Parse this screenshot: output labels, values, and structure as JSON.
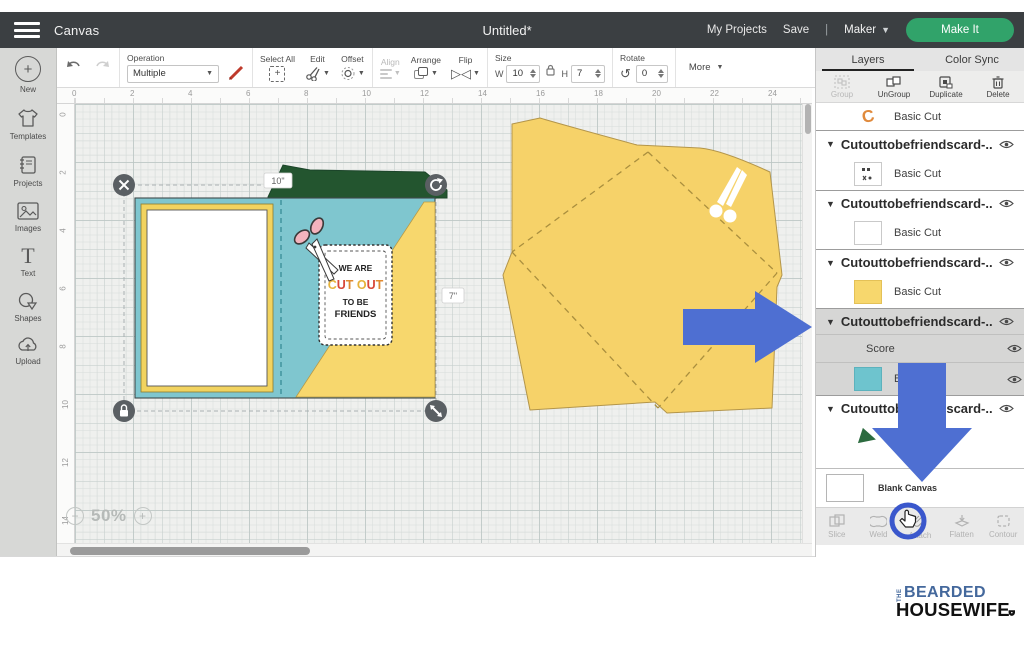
{
  "topbar": {
    "canvas_label": "Canvas",
    "title": "Untitled*",
    "my_projects": "My Projects",
    "save": "Save",
    "divider": "|",
    "machine": "Maker",
    "make_it": "Make It"
  },
  "toolbar": {
    "operation_label": "Operation",
    "operation_value": "Multiple",
    "select_all": "Select All",
    "edit": "Edit",
    "offset": "Offset",
    "align": "Align",
    "arrange": "Arrange",
    "flip": "Flip",
    "size_label": "Size",
    "width_label": "W",
    "width_value": "10",
    "height_label": "H",
    "height_value": "7",
    "rotate_label": "Rotate",
    "rotate_value": "0",
    "more_label": "More"
  },
  "sidebar": {
    "items": [
      {
        "label": "New",
        "icon": "plus-circle-icon"
      },
      {
        "label": "Templates",
        "icon": "tshirt-icon"
      },
      {
        "label": "Projects",
        "icon": "notebook-icon"
      },
      {
        "label": "Images",
        "icon": "image-icon"
      },
      {
        "label": "Text",
        "icon": "text-icon"
      },
      {
        "label": "Shapes",
        "icon": "shapes-icon"
      },
      {
        "label": "Upload",
        "icon": "upload-cloud-icon"
      }
    ]
  },
  "ruler": {
    "horizontal": [
      "0",
      "2",
      "4",
      "6",
      "8",
      "10",
      "12",
      "14",
      "16",
      "18",
      "20",
      "22",
      "24"
    ],
    "vertical": [
      "0",
      "2",
      "4",
      "6",
      "8",
      "10",
      "12",
      "14"
    ]
  },
  "canvas": {
    "zoom_minus": "−",
    "zoom_level": "50%",
    "zoom_plus": "+",
    "selection_width": "10\"",
    "selection_height": "7\"",
    "tag": {
      "line1": "WE ARE",
      "line2": "CUT OUT",
      "line3": "TO BE",
      "line4": "FRIENDS",
      "letter_colors": [
        "#e6b33b",
        "#d8483a",
        "#e08a30"
      ]
    }
  },
  "layers_panel": {
    "tabs": [
      {
        "label": "Layers"
      },
      {
        "label": "Color Sync"
      }
    ],
    "actions": [
      {
        "label": "Group",
        "disabled": true
      },
      {
        "label": "UnGroup"
      },
      {
        "label": "Duplicate"
      },
      {
        "label": "Delete"
      }
    ],
    "rows": [
      {
        "label": "Basic Cut",
        "thumb": "orange-shape"
      },
      {
        "label": "Cutouttobefriendscard-...",
        "type": "group"
      },
      {
        "label": "Basic Cut",
        "thumb": "scissors-glyph"
      },
      {
        "label": "Cutouttobefriendscard-...",
        "type": "group"
      },
      {
        "label": "Basic Cut",
        "thumb": "white"
      },
      {
        "label": "Cutouttobefriendscard-...",
        "type": "group"
      },
      {
        "label": "Basic Cut",
        "thumb": "yellow"
      },
      {
        "label": "Cutouttobefriendscard-...",
        "type": "group",
        "selected": true
      },
      {
        "label": "Score",
        "selected": true
      },
      {
        "label": "Basic Cut",
        "thumb": "teal",
        "selected": true
      },
      {
        "label": "Cutouttobefriendscard-...",
        "type": "group"
      },
      {
        "label": "Basic Cut",
        "thumb": "green-triangle"
      }
    ],
    "blank_canvas": "Blank Canvas",
    "bottom_actions": [
      {
        "label": "Slice"
      },
      {
        "label": "Weld"
      },
      {
        "label": "Attach",
        "highlighted": true
      },
      {
        "label": "Flatten"
      },
      {
        "label": "Contour"
      }
    ]
  },
  "logo": {
    "the": "THE",
    "bearded": "BEARDED",
    "housewife": "HOUSEWIFE"
  },
  "colors": {
    "accent_green": "#31a36a",
    "arrow_blue": "#4e6fd2",
    "card_teal": "#7fc6cf",
    "card_yellow": "#f7d76d",
    "flap_green": "#23552f",
    "envelope_yellow": "#f6d269",
    "logo_blue": "#44689c",
    "topbar_gray": "#3b3f42"
  }
}
